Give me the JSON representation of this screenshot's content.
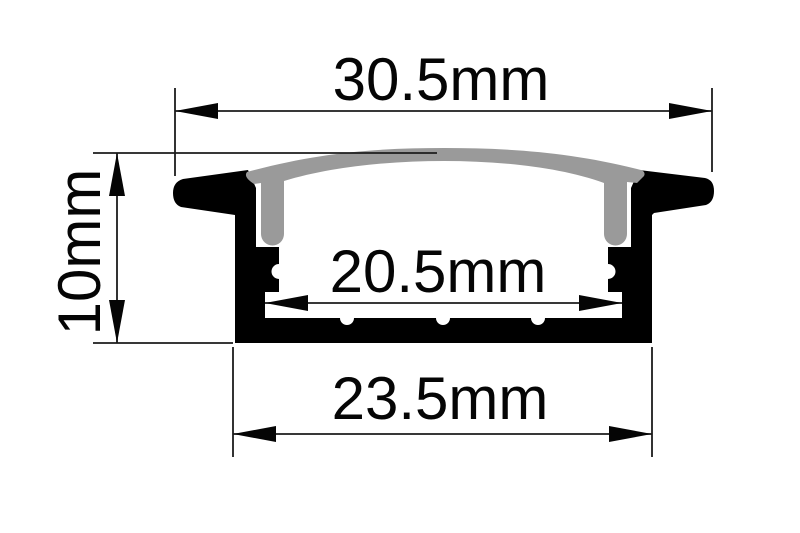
{
  "diagram": {
    "type": "led-profile-cross-section",
    "dimensions": {
      "top_width": "30.5mm",
      "height": "10mm",
      "inner_width": "20.5mm",
      "bottom_width": "23.5mm"
    },
    "colors": {
      "profile": "#000000",
      "diffuser": "#9a9a9a",
      "line": "#1c1c1c",
      "background": "#ffffff"
    }
  }
}
